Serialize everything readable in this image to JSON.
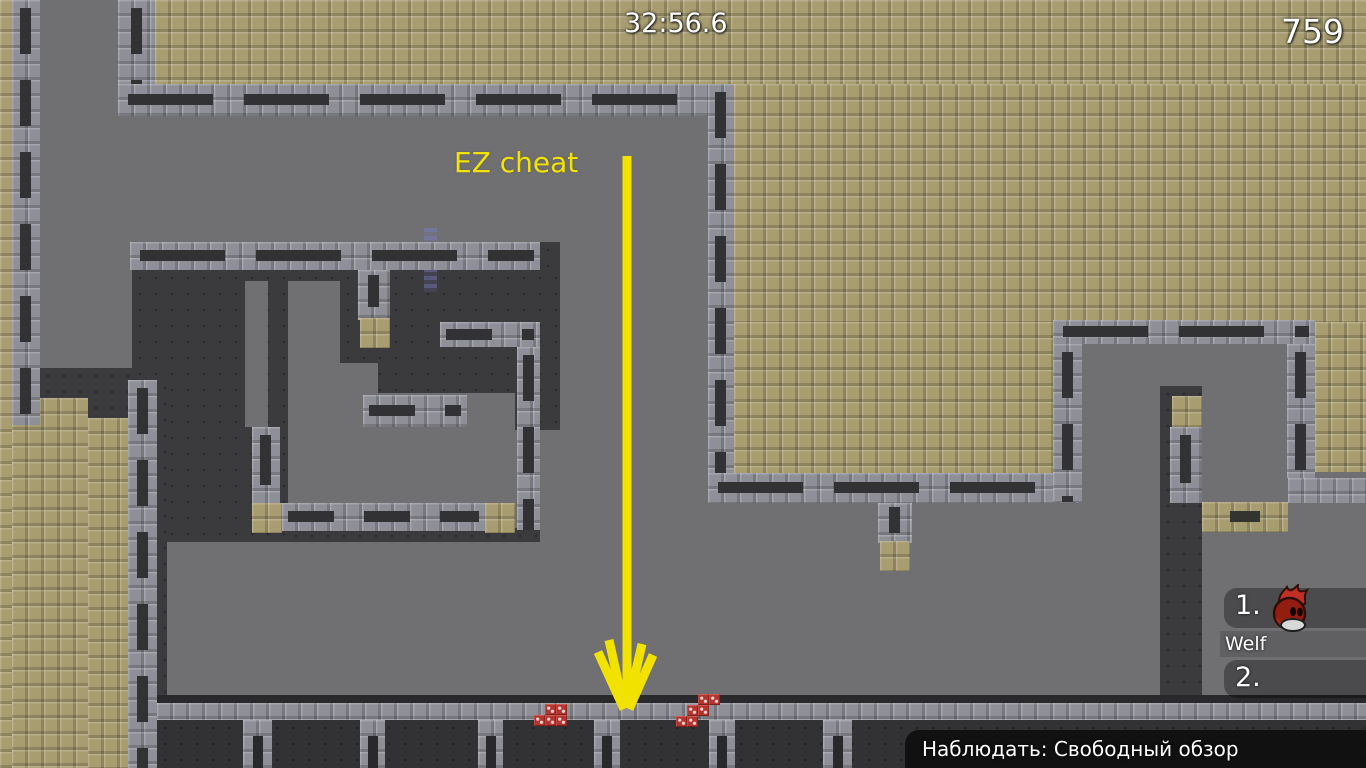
{
  "hud": {
    "timer": "32:56.6",
    "score": "759",
    "annotation": "EZ cheat",
    "spectate_label": "Наблюдать: Свободный обзор",
    "scoreboard": {
      "rows": [
        {
          "rank": "1.",
          "name": "Welf",
          "has_character": true
        },
        {
          "rank": "2.",
          "name": "",
          "has_character": false
        }
      ]
    }
  },
  "colors": {
    "arrow": "#f2e200",
    "annotation_text": "#f2e206",
    "freeze_tile": "#b23530",
    "wall_tile": "#8f8f98",
    "background_tile": "#a89d70",
    "room_interior": "#707073",
    "dark_interior": "#3b3b3e",
    "character_body": "#931d10"
  },
  "map": {
    "tile_size": 16,
    "rects": [
      {
        "t": "dark",
        "x": 40,
        "y": 368,
        "w": 92,
        "h": 52
      },
      {
        "t": "dark",
        "x": 132,
        "y": 270,
        "w": 428,
        "h": 160
      },
      {
        "t": "dark",
        "x": 540,
        "y": 242,
        "w": 20,
        "h": 28
      },
      {
        "t": "dark",
        "x": 132,
        "y": 430,
        "w": 156,
        "h": 112
      },
      {
        "t": "dark",
        "x": 288,
        "y": 528,
        "w": 252,
        "h": 14
      },
      {
        "t": "dark",
        "x": 157,
        "y": 380,
        "w": 10,
        "h": 315
      },
      {
        "t": "dark",
        "x": 1160,
        "y": 386,
        "w": 42,
        "h": 317
      },
      {
        "t": "darker",
        "x": 157,
        "y": 695,
        "w": 1209,
        "h": 8
      },
      {
        "t": "below",
        "x": 157,
        "y": 720,
        "w": 1209,
        "h": 48
      },
      {
        "t": "mid",
        "x": 245,
        "y": 281,
        "w": 23,
        "h": 146
      },
      {
        "t": "mid",
        "x": 288,
        "y": 281,
        "w": 52,
        "h": 112
      },
      {
        "t": "mid",
        "x": 340,
        "y": 363,
        "w": 38,
        "h": 30
      },
      {
        "t": "mid",
        "x": 288,
        "y": 393,
        "w": 227,
        "h": 110
      },
      {
        "t": "blue",
        "x": 424,
        "y": 228,
        "w": 13,
        "h": 64
      },
      {
        "t": "tan",
        "x": 0,
        "y": 0,
        "w": 12,
        "h": 768
      },
      {
        "t": "tan",
        "x": 12,
        "y": 398,
        "w": 76,
        "h": 370
      },
      {
        "t": "tan",
        "x": 88,
        "y": 418,
        "w": 40,
        "h": 350
      },
      {
        "t": "tan",
        "x": 155,
        "y": 0,
        "w": 1211,
        "h": 84
      },
      {
        "t": "tan",
        "x": 734,
        "y": 84,
        "w": 632,
        "h": 238
      },
      {
        "t": "tan",
        "x": 734,
        "y": 322,
        "w": 321,
        "h": 153
      },
      {
        "t": "tan",
        "x": 1315,
        "y": 322,
        "w": 51,
        "h": 150
      },
      {
        "t": "wallv",
        "x": 12,
        "y": 0,
        "w": 28,
        "h": 425
      },
      {
        "t": "wallv",
        "x": 118,
        "y": 0,
        "w": 37,
        "h": 116
      },
      {
        "t": "wallh",
        "x": 118,
        "y": 84,
        "w": 592,
        "h": 32
      },
      {
        "t": "wallh",
        "x": 130,
        "y": 242,
        "w": 410,
        "h": 28
      },
      {
        "t": "slotv",
        "x": 358,
        "y": 270,
        "w": 32,
        "h": 50
      },
      {
        "t": "tan",
        "x": 360,
        "y": 318,
        "w": 30,
        "h": 30
      },
      {
        "t": "wallh2",
        "x": 440,
        "y": 322,
        "w": 100,
        "h": 25
      },
      {
        "t": "wallv",
        "x": 517,
        "y": 347,
        "w": 23,
        "h": 183
      },
      {
        "t": "wallh2",
        "x": 363,
        "y": 395,
        "w": 104,
        "h": 32
      },
      {
        "t": "slotv",
        "x": 252,
        "y": 427,
        "w": 28,
        "h": 78
      },
      {
        "t": "wallh2",
        "x": 282,
        "y": 503,
        "w": 203,
        "h": 28
      },
      {
        "t": "tan",
        "x": 252,
        "y": 503,
        "w": 30,
        "h": 30
      },
      {
        "t": "tan",
        "x": 485,
        "y": 503,
        "w": 30,
        "h": 30
      },
      {
        "t": "wallv",
        "x": 708,
        "y": 84,
        "w": 26,
        "h": 419
      },
      {
        "t": "wallh",
        "x": 708,
        "y": 473,
        "w": 374,
        "h": 30
      },
      {
        "t": "slotv",
        "x": 878,
        "y": 503,
        "w": 34,
        "h": 40
      },
      {
        "t": "tan",
        "x": 880,
        "y": 541,
        "w": 30,
        "h": 30
      },
      {
        "t": "wallh",
        "x": 1053,
        "y": 320,
        "w": 262,
        "h": 24
      },
      {
        "t": "wallv",
        "x": 1053,
        "y": 344,
        "w": 29,
        "h": 158
      },
      {
        "t": "wallv",
        "x": 1287,
        "y": 344,
        "w": 28,
        "h": 134
      },
      {
        "t": "wall",
        "x": 1288,
        "y": 478,
        "w": 78,
        "h": 25
      },
      {
        "t": "slotv",
        "x": 1170,
        "y": 427,
        "w": 32,
        "h": 76
      },
      {
        "t": "tan",
        "x": 1172,
        "y": 396,
        "w": 30,
        "h": 31
      },
      {
        "t": "tanh",
        "x": 1202,
        "y": 502,
        "w": 86,
        "h": 30
      },
      {
        "t": "wallv",
        "x": 128,
        "y": 380,
        "w": 29,
        "h": 388
      },
      {
        "t": "wall",
        "x": 157,
        "y": 703,
        "w": 1209,
        "h": 17
      },
      {
        "t": "pillar",
        "x": 243,
        "y": 720,
        "w": 29,
        "h": 48
      },
      {
        "t": "pillar",
        "x": 360,
        "y": 720,
        "w": 25,
        "h": 48
      },
      {
        "t": "pillar",
        "x": 478,
        "y": 720,
        "w": 25,
        "h": 48
      },
      {
        "t": "pillar",
        "x": 594,
        "y": 720,
        "w": 26,
        "h": 48
      },
      {
        "t": "pillar",
        "x": 709,
        "y": 720,
        "w": 26,
        "h": 48
      },
      {
        "t": "pillar",
        "x": 823,
        "y": 720,
        "w": 29,
        "h": 48
      }
    ],
    "red_tiles": [
      {
        "x": 545,
        "y": 704
      },
      {
        "x": 556,
        "y": 704
      },
      {
        "x": 534,
        "y": 715
      },
      {
        "x": 545,
        "y": 715
      },
      {
        "x": 556,
        "y": 715
      },
      {
        "x": 698,
        "y": 694
      },
      {
        "x": 709,
        "y": 694
      },
      {
        "x": 687,
        "y": 705
      },
      {
        "x": 698,
        "y": 705
      },
      {
        "x": 676,
        "y": 716
      },
      {
        "x": 687,
        "y": 716
      }
    ]
  }
}
